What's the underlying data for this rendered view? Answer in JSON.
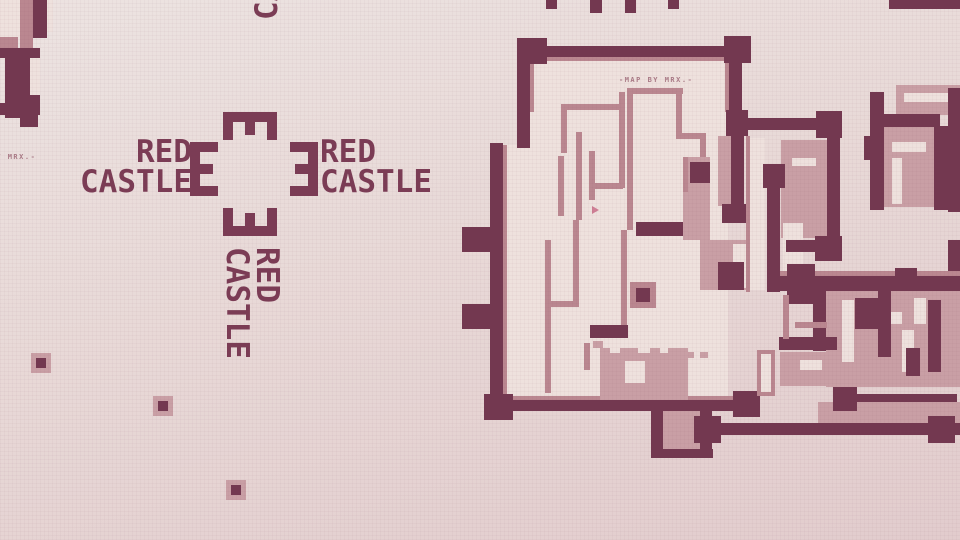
{
  "logo": {
    "monogram_letter": "E",
    "arms": [
      {
        "side": "left",
        "line1": "RED",
        "line2": "CASTLE"
      },
      {
        "side": "right",
        "line1": "RED",
        "line2": "CASTLE"
      },
      {
        "side": "top",
        "line1": "RED",
        "line2": "CASTLE"
      },
      {
        "side": "bottom",
        "line1": "RED",
        "line2": "CASTLE"
      }
    ]
  },
  "map_credit": {
    "text": "-MAP BY MRX.-"
  },
  "colors": {
    "background_top": "#ece3e1",
    "background_bottom": "#e2cccd",
    "wall_dark": "#733850",
    "wall_rose": "#ba8790",
    "fill_rose": "#c99fa5",
    "floor_light": "#eee1dd",
    "logo_text": "#7b3c55",
    "credit_text": "#a97a86",
    "marker_pink": "#cf7f95"
  }
}
